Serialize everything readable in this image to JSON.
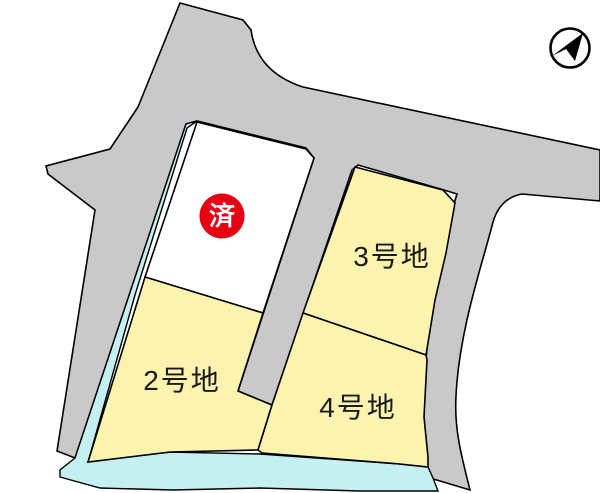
{
  "map": {
    "type": "residential-lot-plan",
    "colors": {
      "road": "#c9c9c9",
      "lot_fill": "#fbf3ae",
      "water_channel": "#c4f0f2",
      "outline": "#000000",
      "sold_badge_fill": "#e60012",
      "sold_badge_text": "#ffffff",
      "label_text": "#1a1a1a",
      "background": "#ffffff"
    },
    "lots": [
      {
        "name": "sold-lot",
        "label": "",
        "status_badge": "済",
        "sold": true
      },
      {
        "name": "lot-2",
        "label": "2号地",
        "sold": false
      },
      {
        "name": "lot-3",
        "label": "3号地",
        "sold": false
      },
      {
        "name": "lot-4",
        "label": "4号地",
        "sold": false
      }
    ],
    "compass": {
      "icon": "north-arrow"
    }
  }
}
